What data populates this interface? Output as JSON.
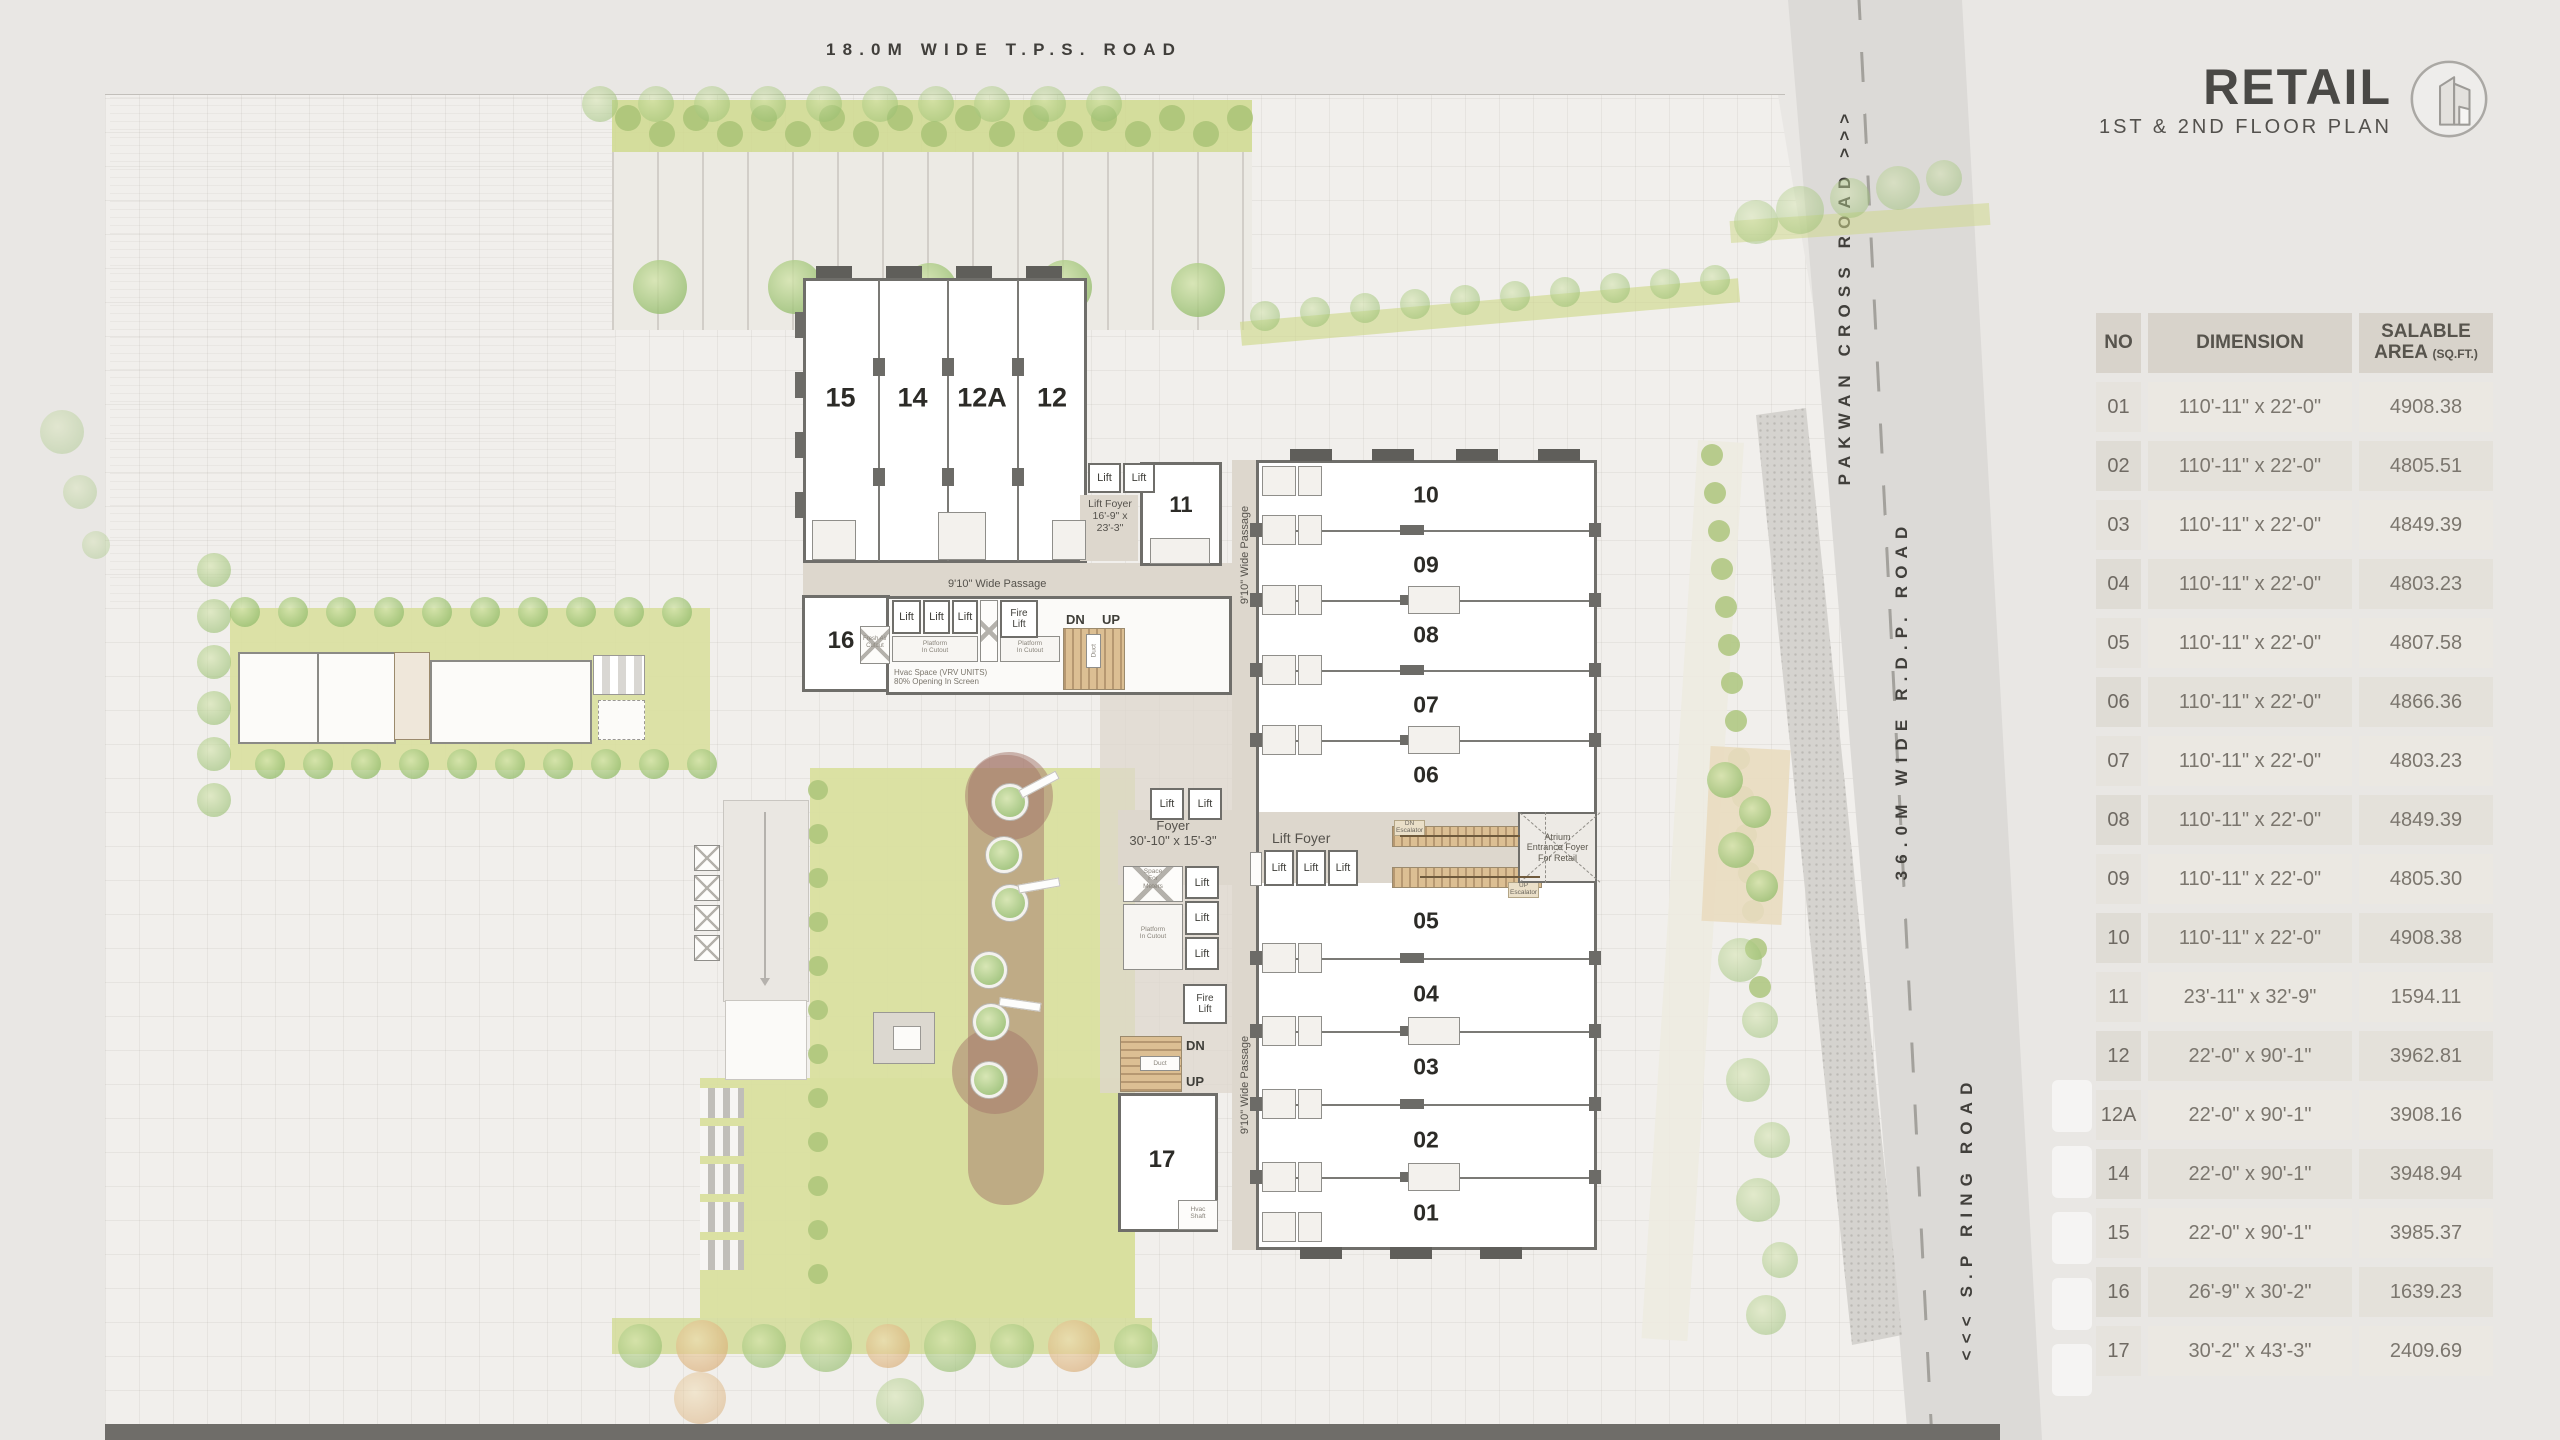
{
  "title_block": {
    "title": "RETAIL",
    "subtitle": "1ST & 2ND FLOOR PLAN",
    "icon": "building-icon"
  },
  "roads": {
    "top": "18.0M WIDE T.P.S. ROAD",
    "cross": "PAKWAN CROSS ROAD >>>",
    "rdp": "36.0M WIDE R.D.P. ROAD",
    "ring": "<<< S.P RING ROAD"
  },
  "table": {
    "headers": {
      "no": "NO",
      "dimension": "DIMENSION",
      "area_line1": "SALABLE",
      "area_line2": "AREA",
      "area_unit": "(SQ.FT.)"
    },
    "rows": [
      {
        "no": "01",
        "dim": "110'-11\" x 22'-0\"",
        "area": "4908.38"
      },
      {
        "no": "02",
        "dim": "110'-11\" x 22'-0\"",
        "area": "4805.51"
      },
      {
        "no": "03",
        "dim": "110'-11\" x 22'-0\"",
        "area": "4849.39"
      },
      {
        "no": "04",
        "dim": "110'-11\" x 22'-0\"",
        "area": "4803.23"
      },
      {
        "no": "05",
        "dim": "110'-11\" x 22'-0\"",
        "area": "4807.58"
      },
      {
        "no": "06",
        "dim": "110'-11\" x 22'-0\"",
        "area": "4866.36"
      },
      {
        "no": "07",
        "dim": "110'-11\" x 22'-0\"",
        "area": "4803.23"
      },
      {
        "no": "08",
        "dim": "110'-11\" x 22'-0\"",
        "area": "4849.39"
      },
      {
        "no": "09",
        "dim": "110'-11\" x 22'-0\"",
        "area": "4805.30"
      },
      {
        "no": "10",
        "dim": "110'-11\" x 22'-0\"",
        "area": "4908.38"
      },
      {
        "no": "11",
        "dim": "23'-11\" x 32'-9\"",
        "area": "1594.11"
      },
      {
        "no": "12",
        "dim": "22'-0\" x 90'-1\"",
        "area": "3962.81"
      },
      {
        "no": "12A",
        "dim": "22'-0\" x 90'-1\"",
        "area": "3908.16"
      },
      {
        "no": "14",
        "dim": "22'-0\" x 90'-1\"",
        "area": "3948.94"
      },
      {
        "no": "15",
        "dim": "22'-0\" x 90'-1\"",
        "area": "3985.37"
      },
      {
        "no": "16",
        "dim": "26'-9\" x 30'-2\"",
        "area": "1639.23"
      },
      {
        "no": "17",
        "dim": "30'-2\" x 43'-3\"",
        "area": "2409.69"
      }
    ]
  },
  "plan": {
    "left_units": [
      "15",
      "14",
      "12A",
      "12"
    ],
    "right_units_top": [
      "10",
      "09",
      "08",
      "07",
      "06"
    ],
    "right_units_bottom": [
      "05",
      "04",
      "03",
      "02",
      "01"
    ],
    "unit_11": "11",
    "unit_16": "16",
    "unit_17": "17",
    "labels": {
      "lift": "Lift",
      "fire_lift": "Fire\nLift",
      "dn": "DN",
      "up": "UP",
      "duct": "Duct",
      "passage": "9'10\" Wide Passage",
      "lift_foyer": "Lift Foyer",
      "lift_foyer_dim": "Lift Foyer\n16'-9\" x\n23'-3\"",
      "foyer_dim": "Foyer\n30'-10\" x 15'-3\"",
      "space_meters": "Space\nFor\nMeters",
      "platform": "Platform\nIn Cutout",
      "fresh_air": "Fresh Air\nCutout",
      "hvac": "Hvac Space (VRV UNITS)\n80% Opening In Screen",
      "hvac_shaft": "Hvac\nShaft",
      "atrium": "Atrium\nEntrance Foyer\nFor Retail",
      "esc_dn": "DN\nEscalator",
      "esc_up": "UP\nEscalator"
    }
  },
  "colors": {
    "page": "#e9e7e4",
    "site": "#f1efec",
    "road": "#dcdad7",
    "wall": "#6f6e6a",
    "taupe": "#ddd7cd",
    "tan": "#dcbf93",
    "lawn": "#d9df9f",
    "hedge": "#cfd98e",
    "thead": "#d8d3cb",
    "ink": "#4a4946"
  }
}
